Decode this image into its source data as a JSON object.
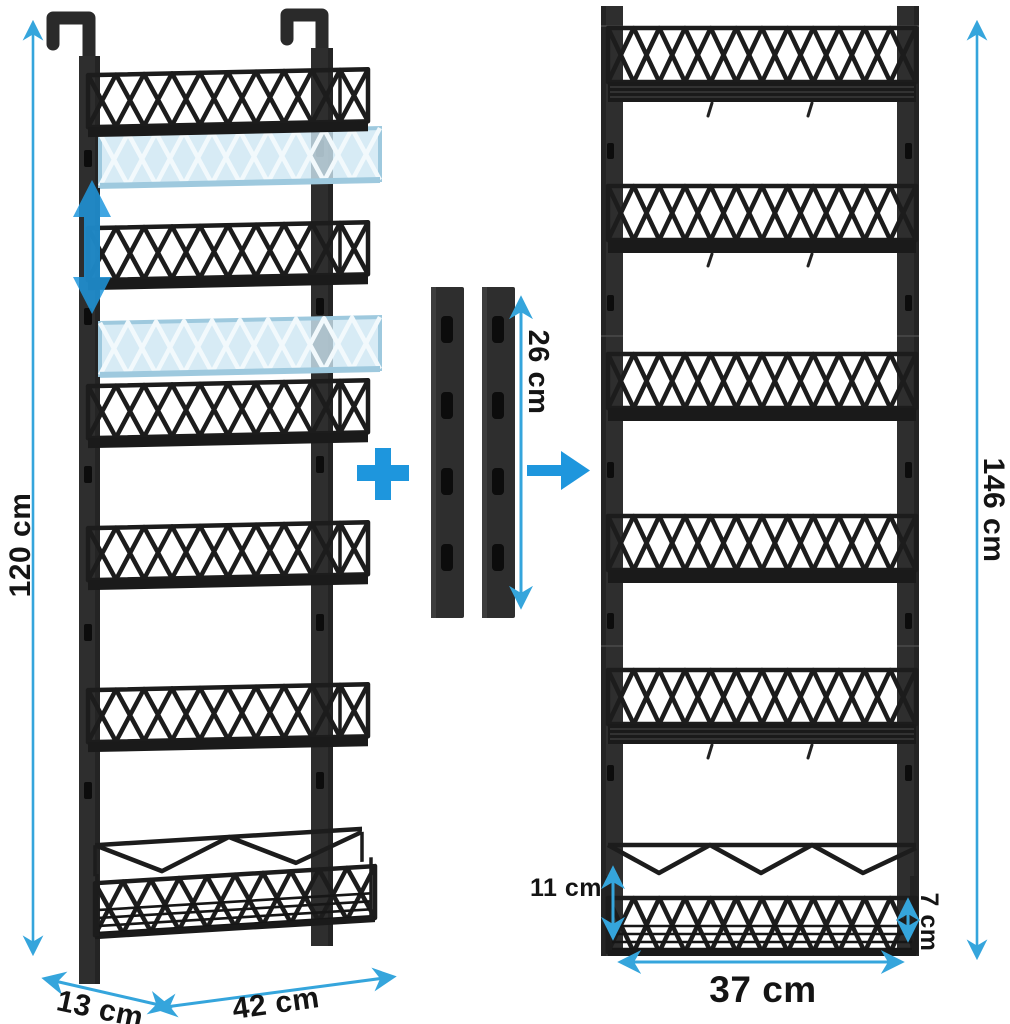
{
  "measurements": {
    "left_rack_height": "120 cm",
    "left_rack_depth": "13 cm",
    "left_rack_width": "42 cm",
    "extension_rail_height": "26 cm",
    "right_rack_height": "146 cm",
    "right_rack_width": "37 cm",
    "bottom_tier_gap": "11 cm",
    "bottom_basket_depth": "7 cm"
  },
  "icons": {
    "plus_icon": "+",
    "arrow_right_icon": "→",
    "up_down_arrow_icon": "↕"
  },
  "colors": {
    "accent_blue": "#1E96DD",
    "dimension_blue": "#35A5DC",
    "ghost_fill": "#CDE6F3",
    "ghost_stroke": "#9EC9DE",
    "rack_dark": "#2E2E2E",
    "wire_black": "#1C1C1C",
    "background": "#FFFFFF"
  },
  "structure": {
    "left_rack_tiers": 6,
    "ghost_adjustable_baskets": 2,
    "extension_rails": 2,
    "extension_rail_slots_per_rail": 4,
    "right_rack_tiers": 6
  }
}
